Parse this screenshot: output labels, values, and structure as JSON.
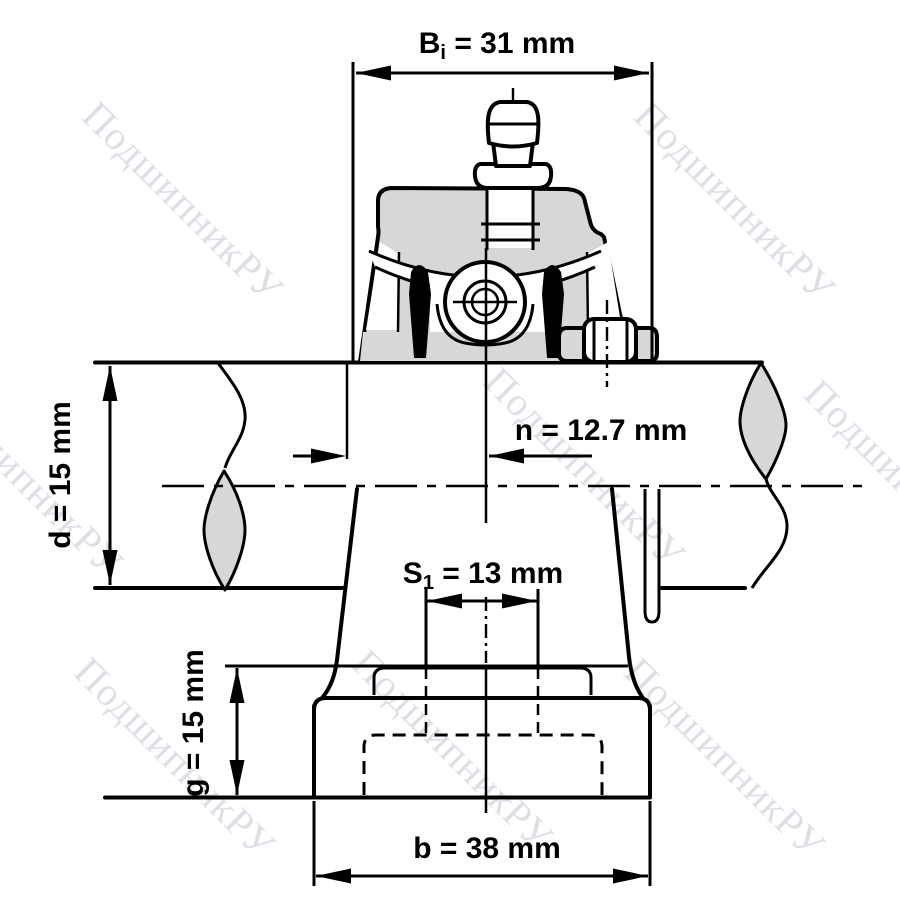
{
  "watermark": {
    "text": "ПодшипникРУ"
  },
  "labels": {
    "bi": {
      "base": "B",
      "sub": "i",
      "rest": " = 31 mm"
    },
    "n": {
      "full": "n = 12.7 mm"
    },
    "d": {
      "full": "d = 15 mm"
    },
    "s1": {
      "base": "S",
      "sub": "1",
      "rest": " = 13 mm"
    },
    "g": {
      "full": "g = 15 mm"
    },
    "b": {
      "full": "b = 38 mm"
    }
  },
  "colors": {
    "line": "#000000",
    "metal_fill": "#d7d7d7",
    "watermark": "#bac0cc",
    "background": "#ffffff"
  }
}
